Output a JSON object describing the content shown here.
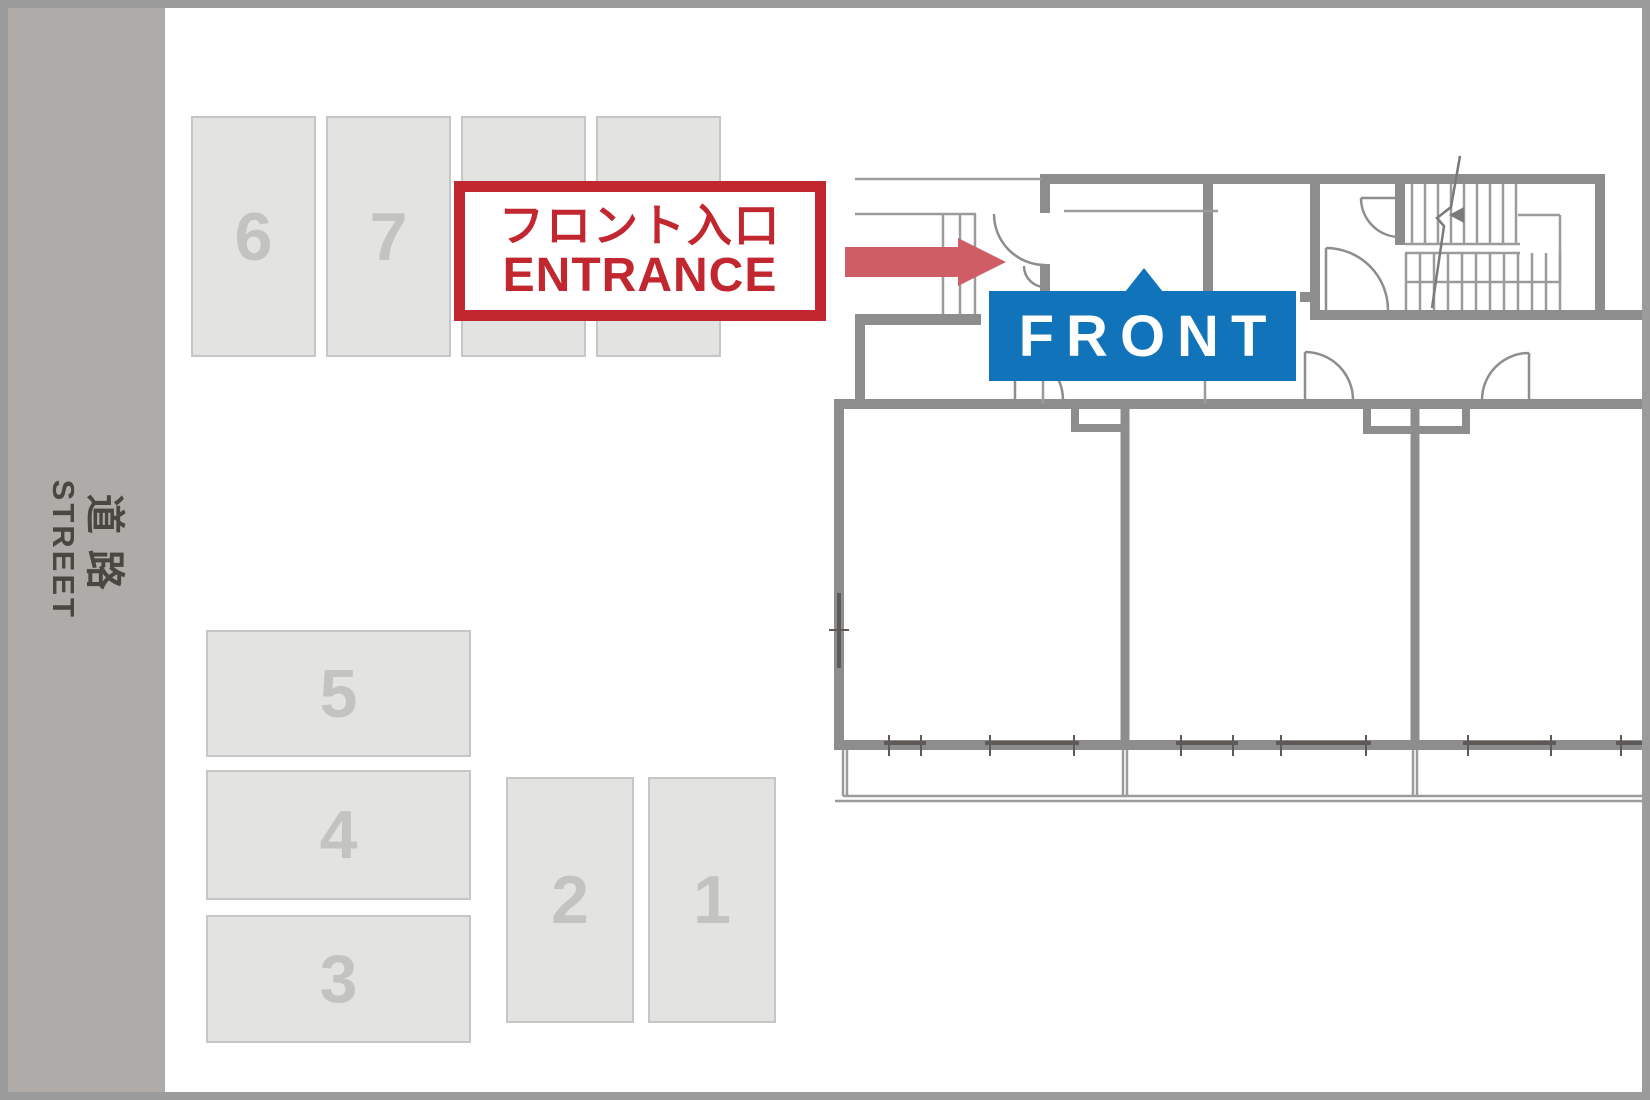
{
  "street": {
    "label_jp": "道路",
    "label_en": "STREET"
  },
  "parking": {
    "spaces": [
      {
        "id": "6",
        "number": "6"
      },
      {
        "id": "7",
        "number": "7"
      },
      {
        "id": "a",
        "number": ""
      },
      {
        "id": "b",
        "number": ""
      },
      {
        "id": "5",
        "number": "5"
      },
      {
        "id": "4",
        "number": "4"
      },
      {
        "id": "3",
        "number": "3"
      },
      {
        "id": "2",
        "number": "2"
      },
      {
        "id": "1",
        "number": "1"
      }
    ]
  },
  "entrance_label": {
    "line1_jp": "フロント入口",
    "line2_en": "ENTRANCE"
  },
  "front_label": {
    "text": "FRONT"
  },
  "colors": {
    "frame": "#9b9b9b",
    "street_band": "#aeaba8",
    "street_text": "#4a4741",
    "parking_fill": "#e3e3e2",
    "parking_border": "#c6c6c5",
    "parking_number": "#c3c3c2",
    "label_red": "#c2262e",
    "arrow_red": "#ce5d66",
    "front_blue": "#1173b9",
    "wall": "#8d8d8d",
    "thin": "#9b9b9b",
    "window": "#5f5a57"
  }
}
